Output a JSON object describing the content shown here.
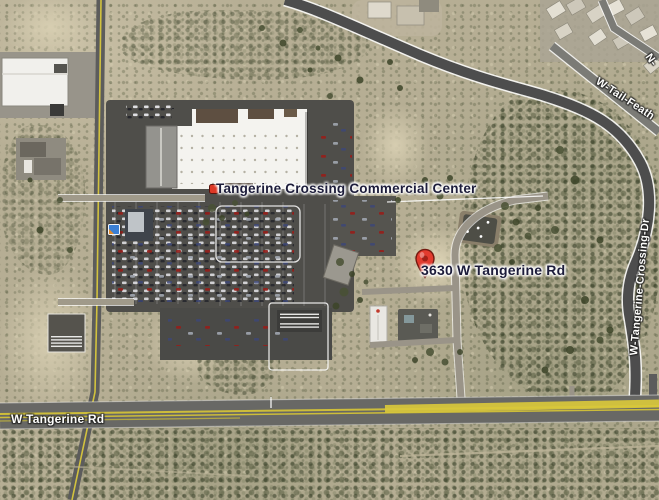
{
  "title": "Satellite map view - Tangerine Crossing",
  "labels": {
    "commercial_center": "Tangerine Crossing Commercial Center",
    "address_placemark": "3630 W Tangerine Rd",
    "road_tangerine": "W Tangerine Rd",
    "road_crossing_dr": "W-Tangerine-Crossing-Dr",
    "road_tail_feather": "W-Tail-Feath",
    "road_north_partial": "N-"
  },
  "markers": {
    "address_pin": {
      "label": "3630 W Tangerine Rd",
      "x": 424,
      "y": 275
    },
    "commercial_center_dot": {
      "label": "Tangerine Crossing Commercial Center",
      "x": 212,
      "y": 187
    },
    "photo_icon": {
      "x": 112,
      "y": 228
    }
  },
  "colors": {
    "placemark_label_navy": "#1c1c3a",
    "road_label_white": "#fdfdfb",
    "road_stripe_yellow": "#d6c53c",
    "pin_red": "#e23b2e",
    "desert_base": "#b6ae94",
    "asphalt": "#4d4d4d"
  }
}
